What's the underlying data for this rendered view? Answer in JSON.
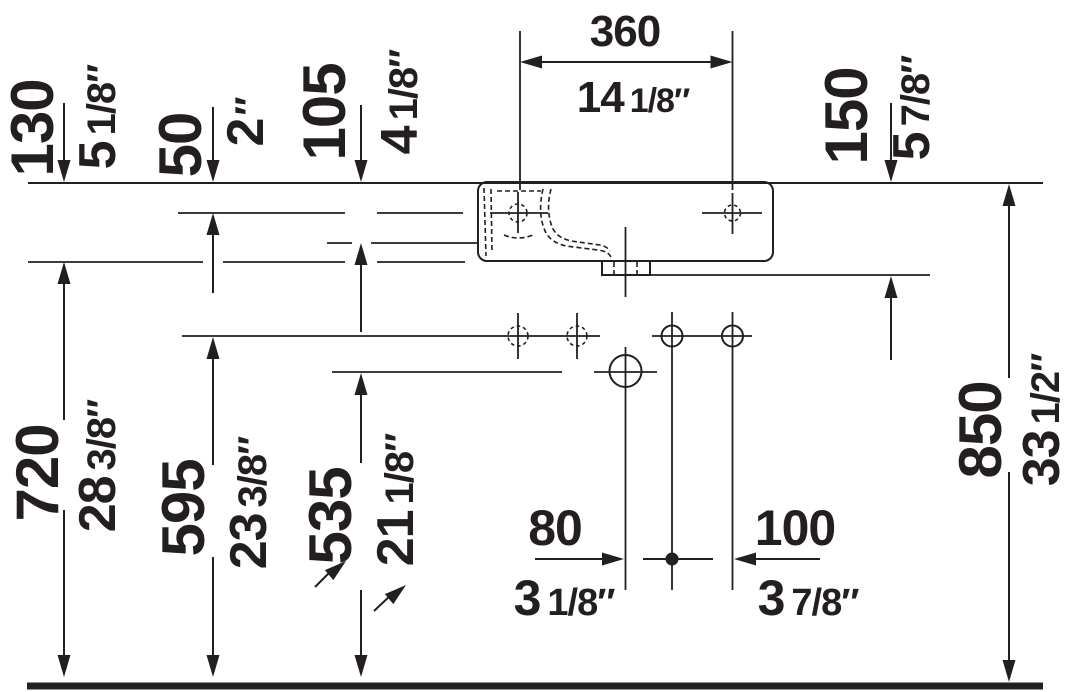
{
  "drawing": {
    "ink_color": "#231f20",
    "background_color": "#ffffff",
    "dimensions": {
      "d130": {
        "mm": "130",
        "in_whole": "5",
        "in_frac": "1/8″"
      },
      "d50": {
        "mm": "50",
        "in_whole": "2",
        "in_frac": "″"
      },
      "d105": {
        "mm": "105",
        "in_whole": "4",
        "in_frac": "1/8″"
      },
      "d360": {
        "mm": "360",
        "in_whole": "14",
        "in_frac": "1/8″"
      },
      "d150": {
        "mm": "150",
        "in_whole": "5",
        "in_frac": "7/8″"
      },
      "d850": {
        "mm": "850",
        "in_whole": "33",
        "in_frac": "1/2″"
      },
      "d720": {
        "mm": "720",
        "in_whole": "28",
        "in_frac": "3/8″"
      },
      "d595": {
        "mm": "595",
        "in_whole": "23",
        "in_frac": "3/8″"
      },
      "d535": {
        "mm": "535",
        "in_whole": "21",
        "in_frac": "1/8″"
      },
      "d80": {
        "mm": "80",
        "in_whole": "3",
        "in_frac": "1/8″"
      },
      "d100": {
        "mm": "100",
        "in_whole": "3",
        "in_frac": "7/8″"
      }
    }
  }
}
